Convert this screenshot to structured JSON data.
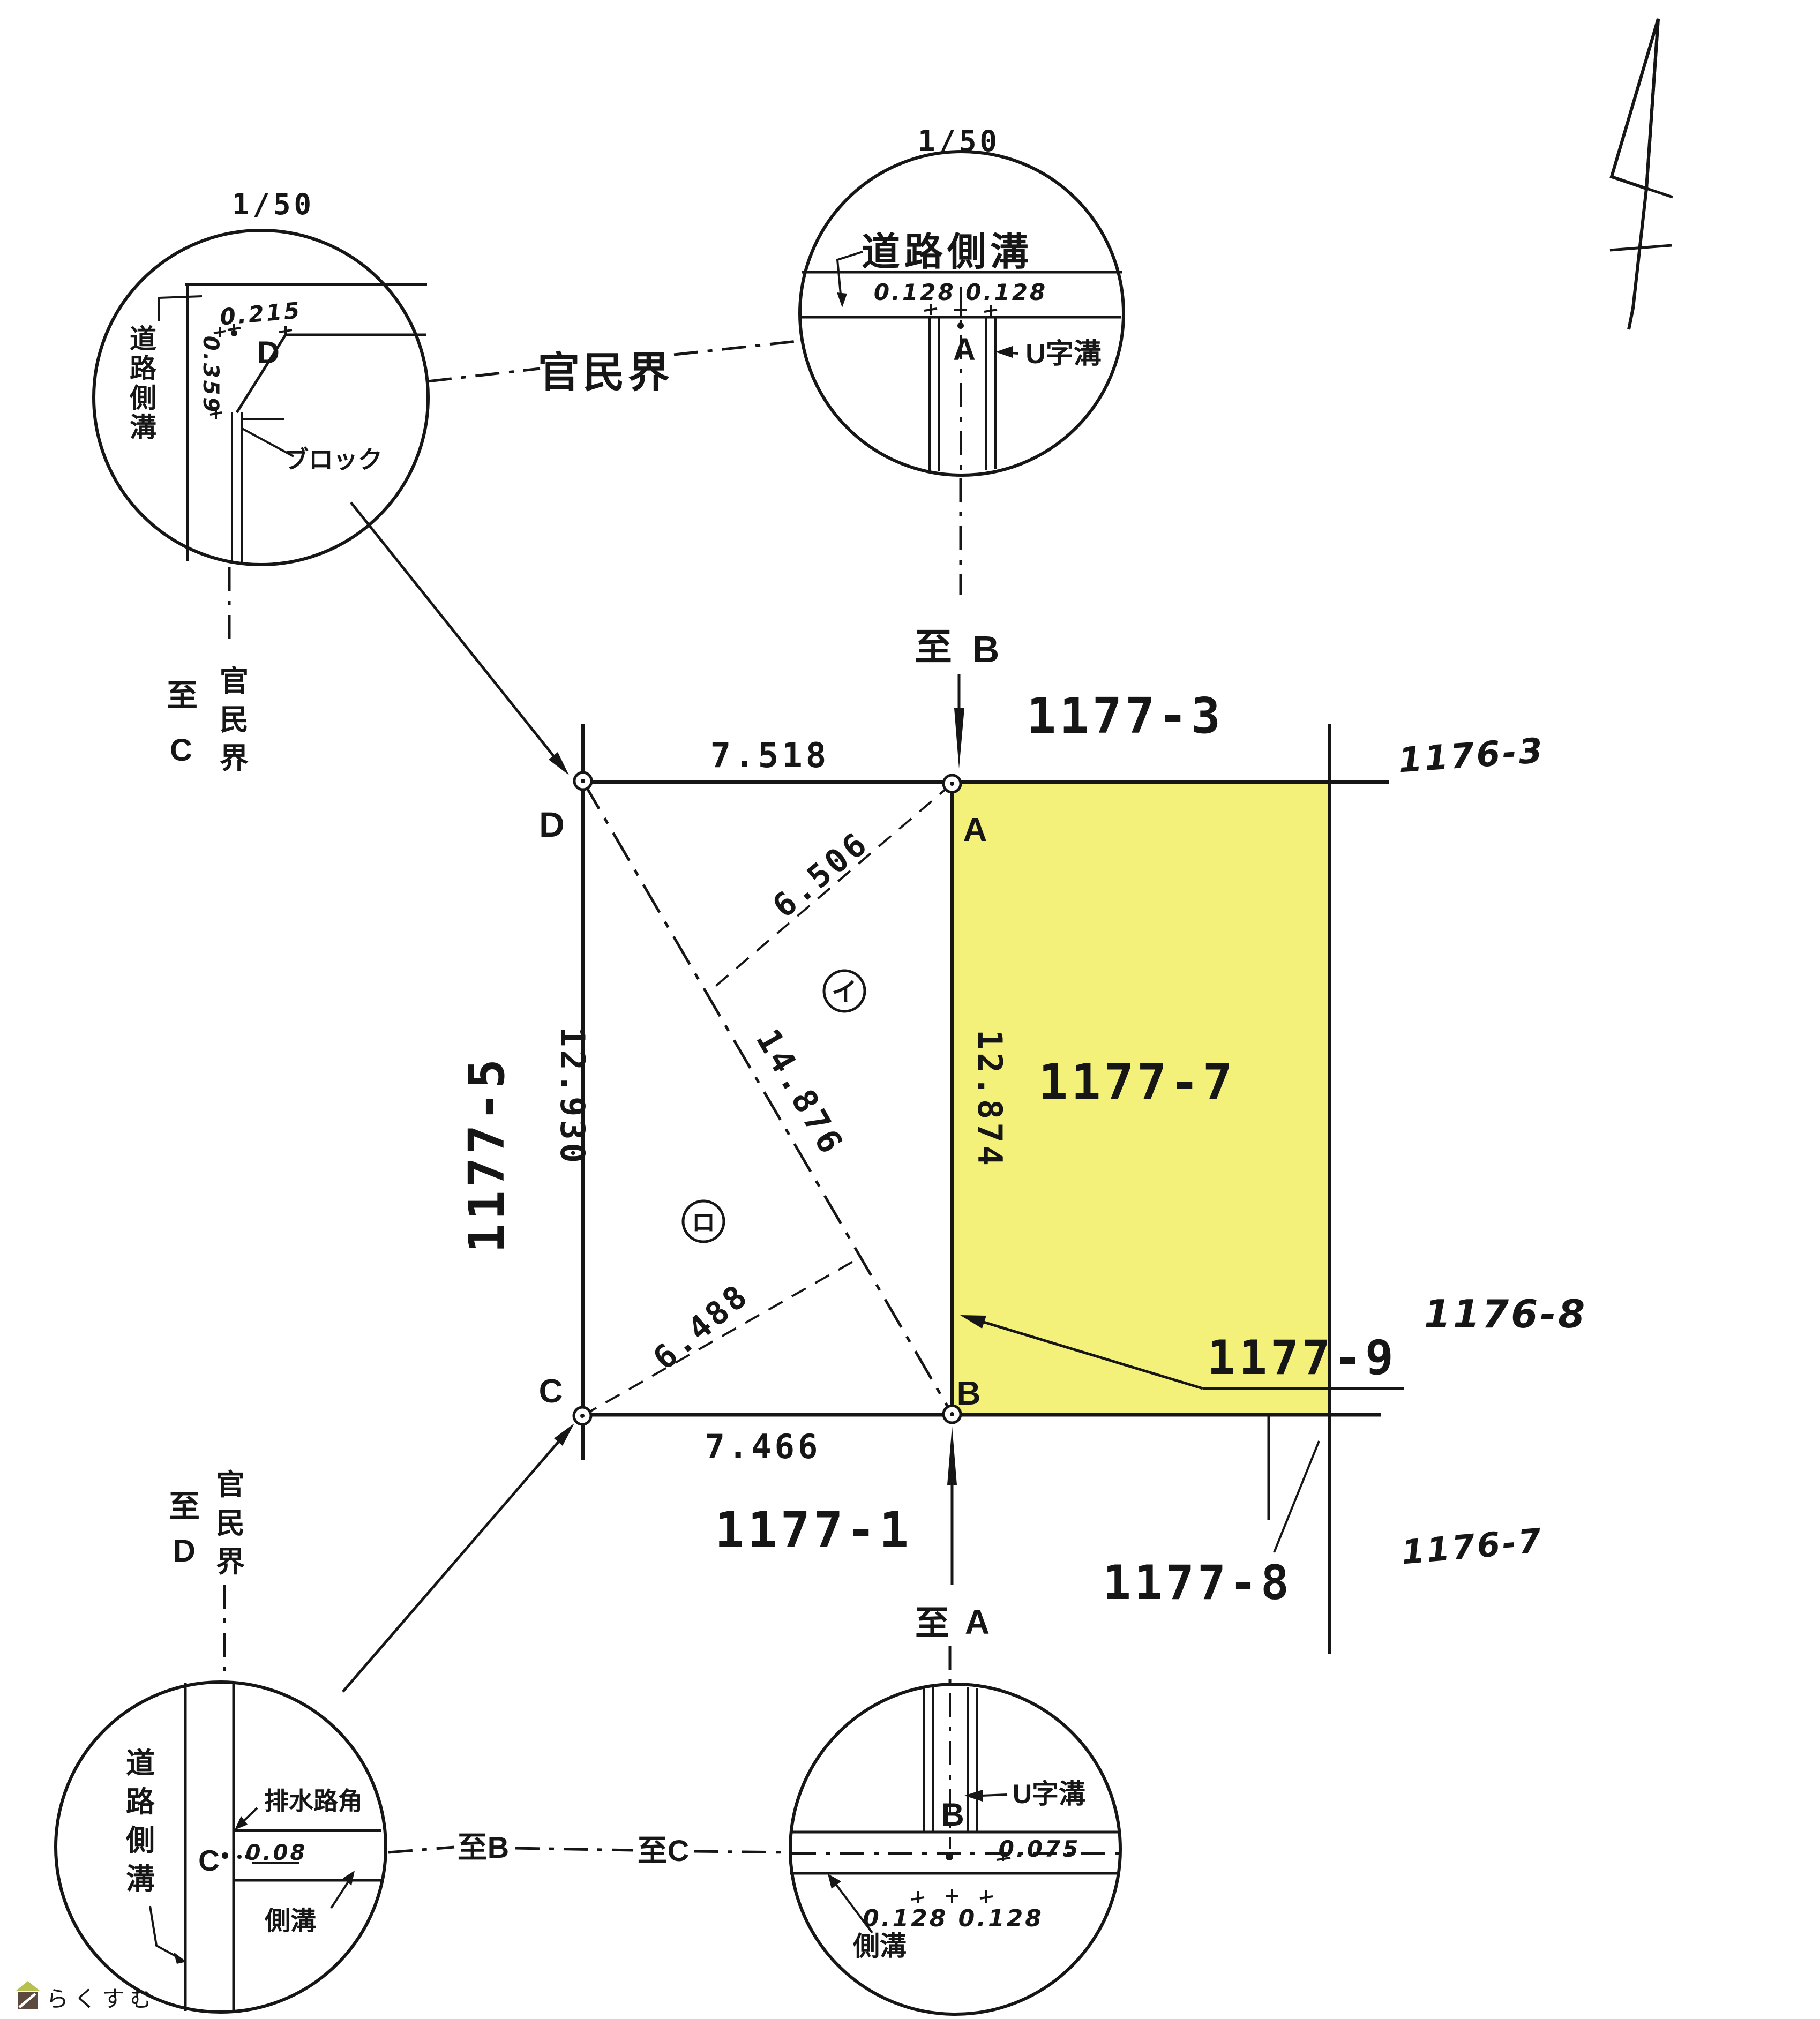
{
  "colors": {
    "highlight": "#f4f17b",
    "ink": "#161616",
    "watermark_text": "#8a7a66",
    "watermark_roof": "#b6c24d",
    "watermark_body": "#5d4a3e"
  },
  "main_map": {
    "parcels": {
      "p1177_3": "1177-3",
      "p1177_5": "1177-5",
      "p1177_7": "1177-7",
      "p1177_9": "1177-9",
      "p1177_1": "1177-1",
      "p1177_8": "1177-8",
      "p1176_3": "1176-3",
      "p1176_8": "1176-8",
      "p1176_7": "1176-7"
    },
    "vertices": {
      "a": "A",
      "b": "B",
      "c": "C",
      "d": "D"
    },
    "dimensions": {
      "top": "7.518",
      "bottom": "7.466",
      "left": "12.930",
      "right": "12.874",
      "diagonal": "14.876",
      "height_a": "6.506",
      "height_c": "6.488"
    },
    "triangle_marks": {
      "i": "イ",
      "ro": "ロ"
    }
  },
  "boundary_label": "官民界",
  "detail_top_left": {
    "scale": "1/50",
    "road_ditch": "道路側溝",
    "dim_top": "0.215",
    "dim_left": "0.359",
    "point": "D",
    "block": "ブロック",
    "to": "至",
    "to_point": "C",
    "boundary": "官民界"
  },
  "detail_top_center": {
    "scale": "1/50",
    "road_ditch": "道路側溝",
    "dims": "0.128 0.128",
    "point": "A",
    "u_ditch": "U字溝",
    "to": "至",
    "to_point": "B"
  },
  "detail_bottom_left": {
    "road_ditch": "道路側溝",
    "drain_corner": "排水路角",
    "point": "C",
    "dim": "0.08",
    "side_ditch": "側溝",
    "to": "至",
    "to_point": "D",
    "boundary": "官民界",
    "to_b": "至B"
  },
  "detail_bottom_center": {
    "to": "至",
    "to_point": "A",
    "u_ditch": "U字溝",
    "point": "B",
    "dim_right": "0.075",
    "dims_bottom": "0.128 0.128",
    "side_ditch": "側溝",
    "to_c": "至C"
  },
  "watermark": {
    "text": "らくすむ"
  }
}
